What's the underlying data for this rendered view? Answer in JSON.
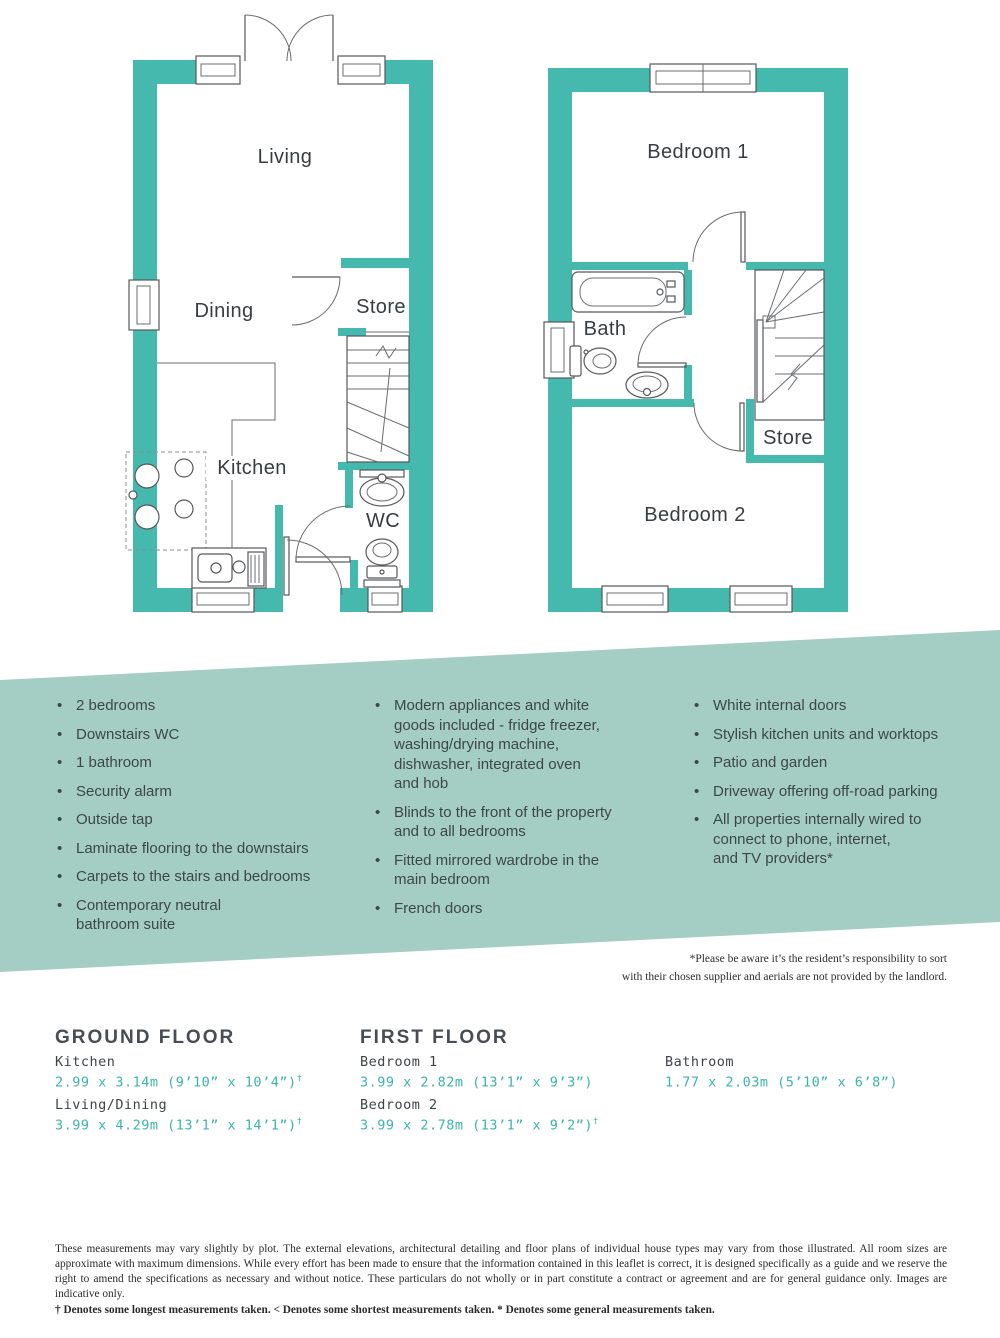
{
  "colors": {
    "wall_teal": "#45b9ae",
    "band_bg": "#a4cdc3",
    "dims_teal": "#3ab5ab",
    "text_dark": "#3d4247"
  },
  "plans": {
    "ground": {
      "living": "Living",
      "dining": "Dining",
      "store": "Store",
      "kitchen": "Kitchen",
      "wc": "WC"
    },
    "first": {
      "bedroom1": "Bedroom 1",
      "bath": "Bath",
      "store": "Store",
      "bedroom2": "Bedroom 2"
    }
  },
  "features": {
    "col1": [
      "2 bedrooms",
      "Downstairs WC",
      "1 bathroom",
      "Security alarm",
      "Outside tap",
      "Laminate flooring to the downstairs",
      "Carpets to the stairs and bedrooms",
      "Contemporary neutral\nbathroom suite"
    ],
    "col2": [
      "Modern appliances and white\ngoods included - fridge freezer,\nwashing/drying machine,\ndishwasher, integrated oven\nand hob",
      "Blinds to the front of the property\nand to all bedrooms",
      "Fitted mirrored wardrobe in the\nmain bedroom",
      "French doors"
    ],
    "col3": [
      "White internal doors",
      "Stylish kitchen units and worktops",
      "Patio and garden",
      "Driveway offering off-road parking",
      "All properties internally wired to\nconnect to phone, internet,\nand TV providers*"
    ]
  },
  "aerials_note": {
    "line1": "*Please be aware it’s the resident’s responsibility to sort",
    "line2": "with their chosen supplier and aerials are not provided by the landlord."
  },
  "dimensions": {
    "ground_heading": "GROUND FLOOR",
    "first_heading": "FIRST FLOOR",
    "entries": [
      {
        "room": "Kitchen",
        "size": "2.99 x 3.14m (9’10” x 10’4”)",
        "sup": "†"
      },
      {
        "room": "Living/Dining",
        "size": "3.99 x 4.29m (13’1” x 14’1”)",
        "sup": "†"
      },
      {
        "room": "Bedroom 1",
        "size": "3.99 x 2.82m (13’1” x 9’3”)",
        "sup": ""
      },
      {
        "room": "Bedroom 2",
        "size": "3.99 x 2.78m (13’1” x 9’2”)",
        "sup": "†"
      },
      {
        "room": "Bathroom",
        "size": "1.77 x 2.03m (5’10” x 6’8”)",
        "sup": ""
      }
    ]
  },
  "disclaimer": {
    "main": "These measurements may vary slightly by plot. The external elevations, architectural detailing and floor plans of individual house types may vary from those illustrated. All room sizes are approximate with maximum dimensions. While every effort has been made to ensure that the information contained in this leaflet is correct, it is designed specifically as a guide and we reserve the right to amend the specifications as necessary and without notice. These particulars do not wholly or in part constitute a contract or agreement and are for general guidance only. Images are indicative only.",
    "denotes": "† Denotes some longest measurements taken. < Denotes some shortest measurements taken. * Denotes some general measurements taken."
  }
}
